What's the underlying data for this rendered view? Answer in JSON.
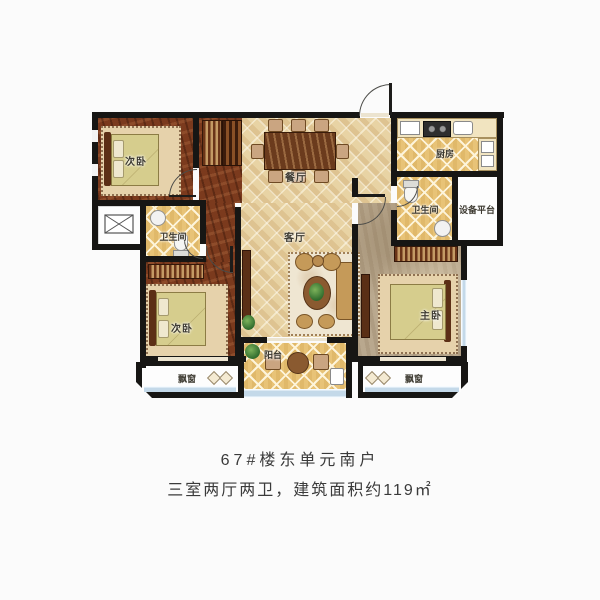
{
  "caption": {
    "line1": "67#楼东单元南户",
    "line2": "三室两厅两卫，建筑面积约119㎡"
  },
  "rooms": {
    "bedroom_top_left": {
      "label": "次卧"
    },
    "bedroom_bottom_left": {
      "label": "次卧"
    },
    "master_bedroom": {
      "label": "主卧"
    },
    "dining_room": {
      "label": "餐厅"
    },
    "living_room": {
      "label": "客厅"
    },
    "kitchen": {
      "label": "厨房"
    },
    "bathroom_left": {
      "label": "卫生间"
    },
    "bathroom_right": {
      "label": "卫生间"
    },
    "equipment_platform": {
      "label": "设备平台"
    },
    "balcony": {
      "label": "阳台"
    },
    "bay_window_left": {
      "label": "飘窗"
    },
    "bay_window_right": {
      "label": "飘窗"
    }
  },
  "colors": {
    "wall": "#171614",
    "tile_floor": "#e8d3a4",
    "wood_floor": "#7b3a1d",
    "kitchen_bath_tile": "#e8c377",
    "master_floor": "#b9a88e",
    "window_glass": "#c4d9e9",
    "bed_blanket": "#d6cd8d",
    "caption_text": "#3a3a3a"
  }
}
